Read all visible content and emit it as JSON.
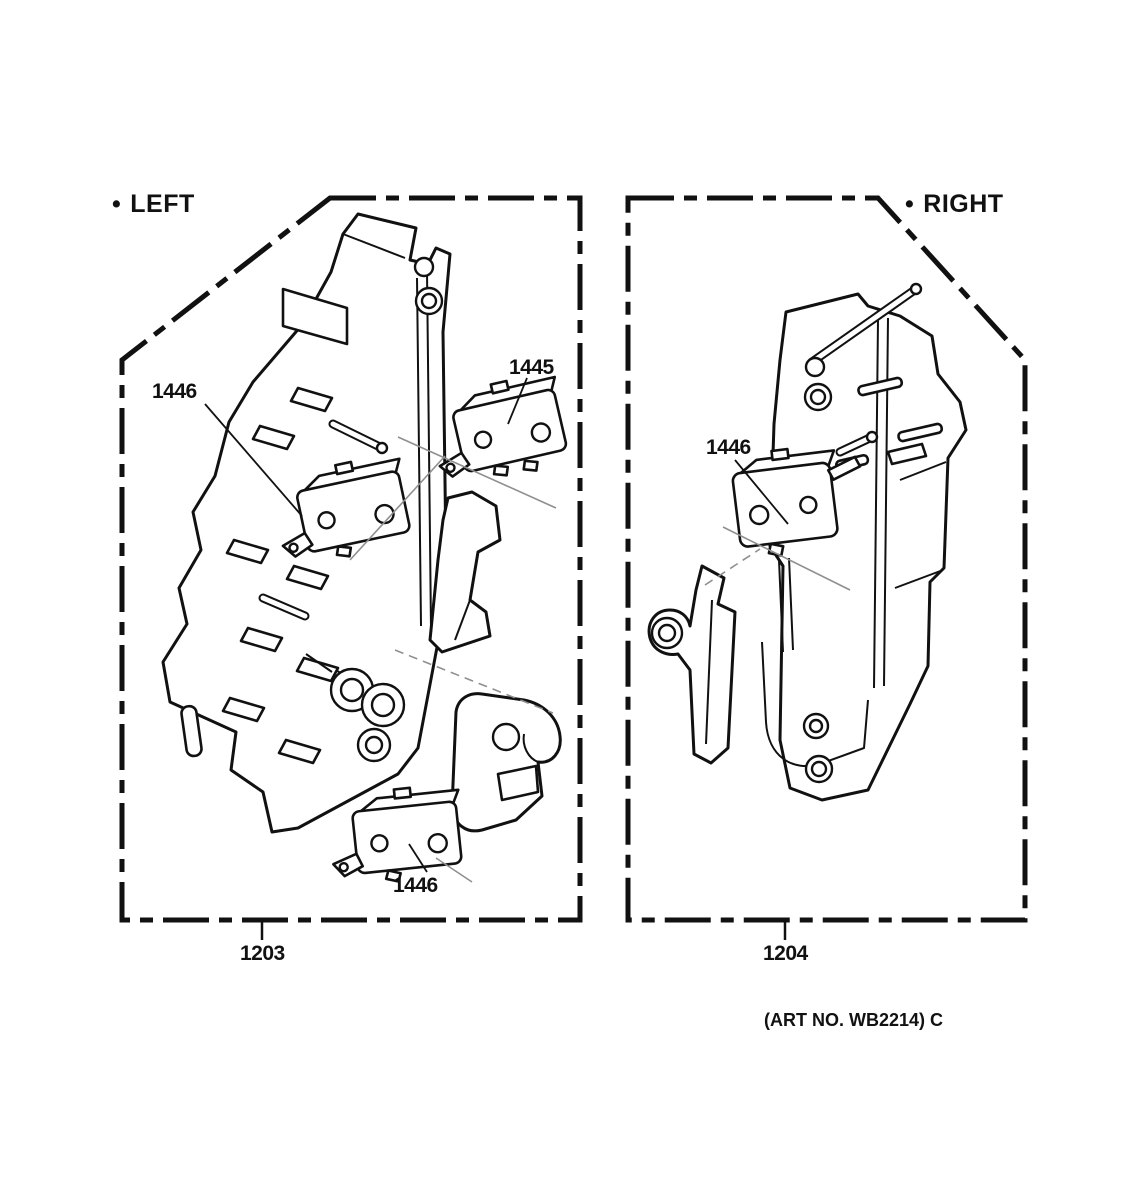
{
  "figure": {
    "art_number": "(ART NO. WB2214) C"
  },
  "panels": {
    "left": {
      "bullet": "•",
      "label": "LEFT",
      "part_number": "1203",
      "callouts": {
        "upper_switch": "1446",
        "detached_switch": "1445",
        "lower_switch": "1446"
      }
    },
    "right": {
      "bullet": "•",
      "label": "RIGHT",
      "part_number": "1204",
      "callouts": {
        "switch": "1446"
      }
    }
  },
  "colors": {
    "line": "#111111",
    "background": "#ffffff",
    "thin_assembly_line": "#8f8f8f"
  }
}
